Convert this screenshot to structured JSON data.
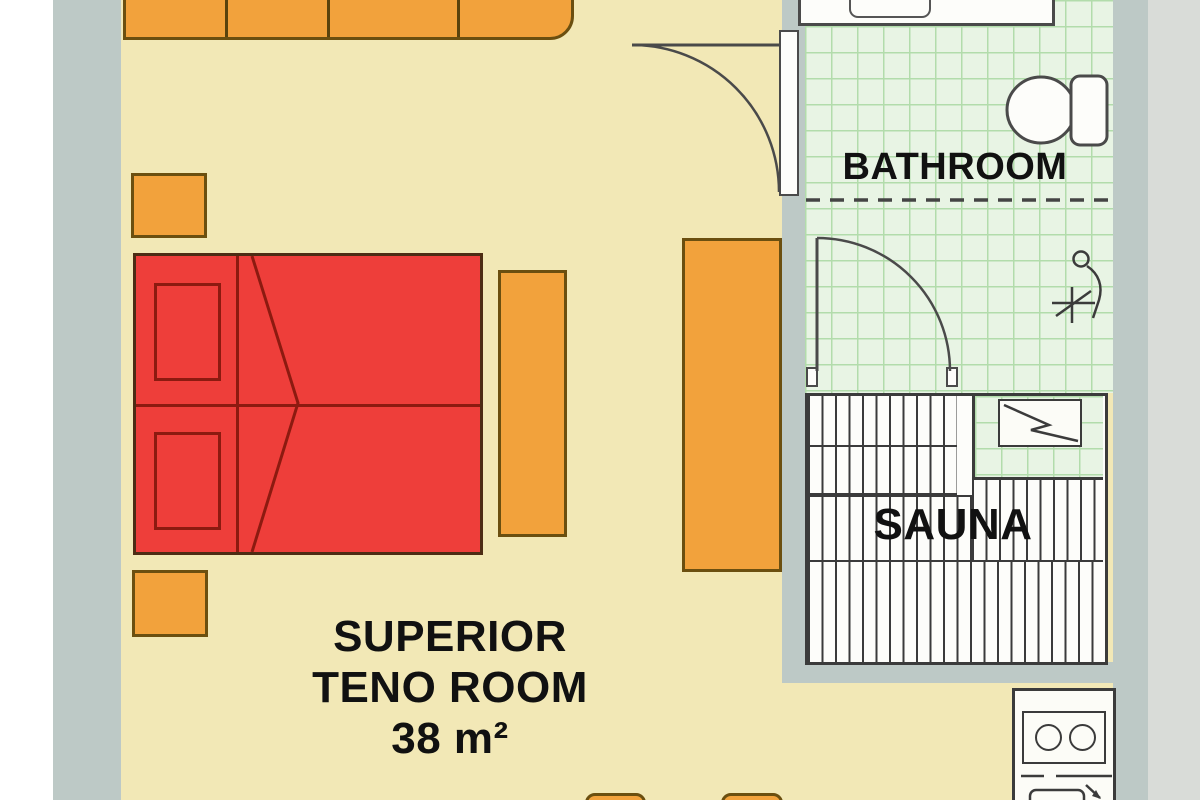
{
  "plan": {
    "labels": {
      "bathroom": "BATHROOM",
      "sauna": "SAUNA",
      "room_line1": "SUPERIOR",
      "room_line2": "TENO ROOM",
      "room_line3": "38 m²"
    },
    "colors": {
      "floor_cream": "#f2e8b6",
      "furniture_orange": "#f2a23c",
      "furniture_border": "#6b4f10",
      "bed_red": "#ee3e3a",
      "bed_border": "#4d2c14",
      "bed_detail_red": "#8c1a10",
      "wall_gray": "#bdc9c6",
      "outer_margin_gray": "#d9dcd8",
      "bathroom_tile_green": "#e8f4e4",
      "tile_grid_green": "#b2dcab",
      "line_dark": "#3b3b3b",
      "label_black": "#111111"
    },
    "icons": [
      "sofa",
      "side-table",
      "double-bed",
      "pillow",
      "bedside-bench",
      "wardrobe",
      "room-door",
      "bathroom-door",
      "sink",
      "basin",
      "toilet",
      "shower",
      "sauna-benches",
      "sauna-heater",
      "kitchenette",
      "stove-burner",
      "stool"
    ]
  }
}
